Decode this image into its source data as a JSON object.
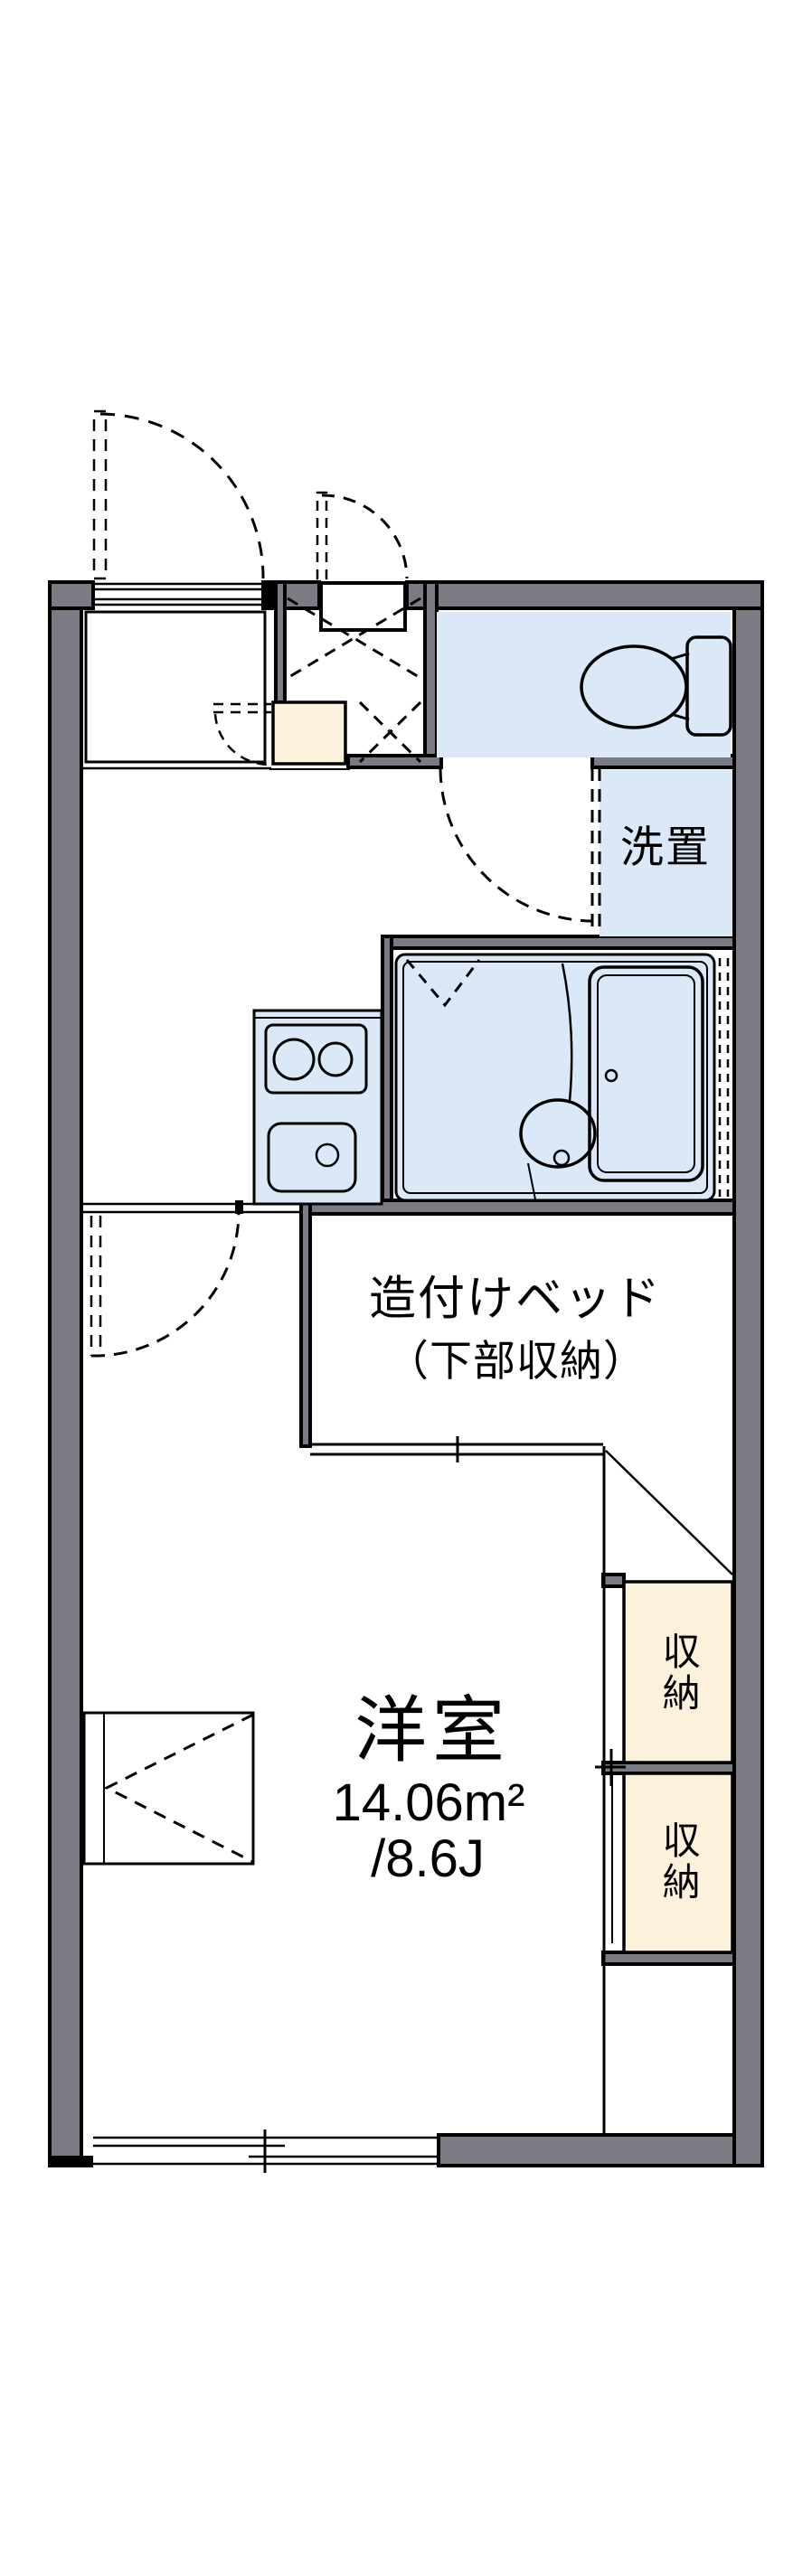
{
  "floorplan": {
    "labels": {
      "bed_line1": "造付けベッド",
      "bed_line2": "（下部収納）",
      "main_room_name": "洋室",
      "main_room_area": "14.06m²",
      "main_room_size": "/8.6J",
      "washer_space": "洗置",
      "storage_upper": "収納",
      "storage_lower": "収納"
    },
    "colors": {
      "wall": "#7b7b83",
      "fixture_blue": "#dbe8f7",
      "storage_cream": "#fcf2dc",
      "line": "#000000",
      "background": "#ffffff"
    }
  }
}
